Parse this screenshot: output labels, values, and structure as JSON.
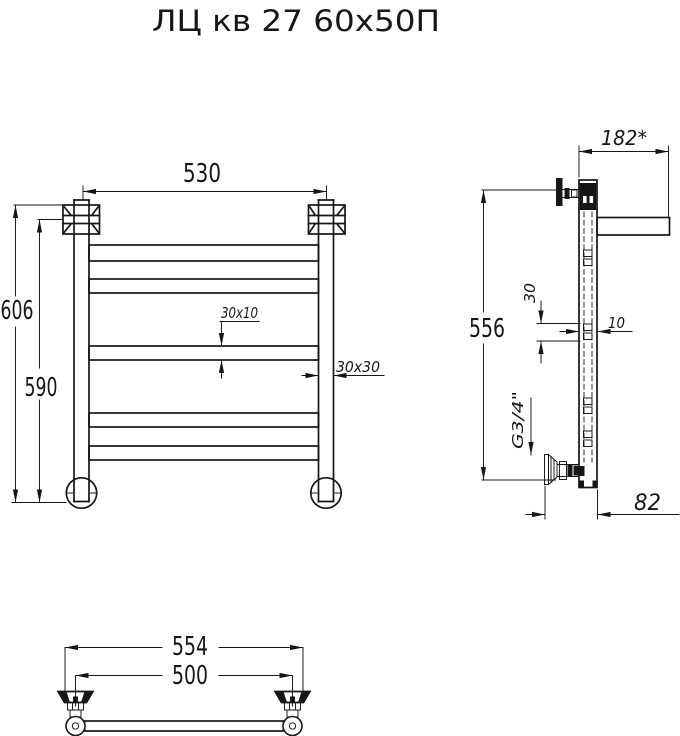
{
  "title": "ЛЦ кв 27 60х50П",
  "colors": {
    "line": "#161616",
    "background": "#ffffff"
  },
  "front_view": {
    "width": "530",
    "height_overall": "606",
    "height_mounts": "590",
    "crossbar_section": "30x10",
    "post_section": "30x30"
  },
  "side_view": {
    "shelf_depth": "182*",
    "mount_height": "556",
    "crossbar_height": "30",
    "crossbar_thickness": "10",
    "thread_size": "G3/4\"",
    "bottom_offset": "82"
  },
  "bottom_view": {
    "width_overall": "554",
    "mount_centers": "500"
  }
}
